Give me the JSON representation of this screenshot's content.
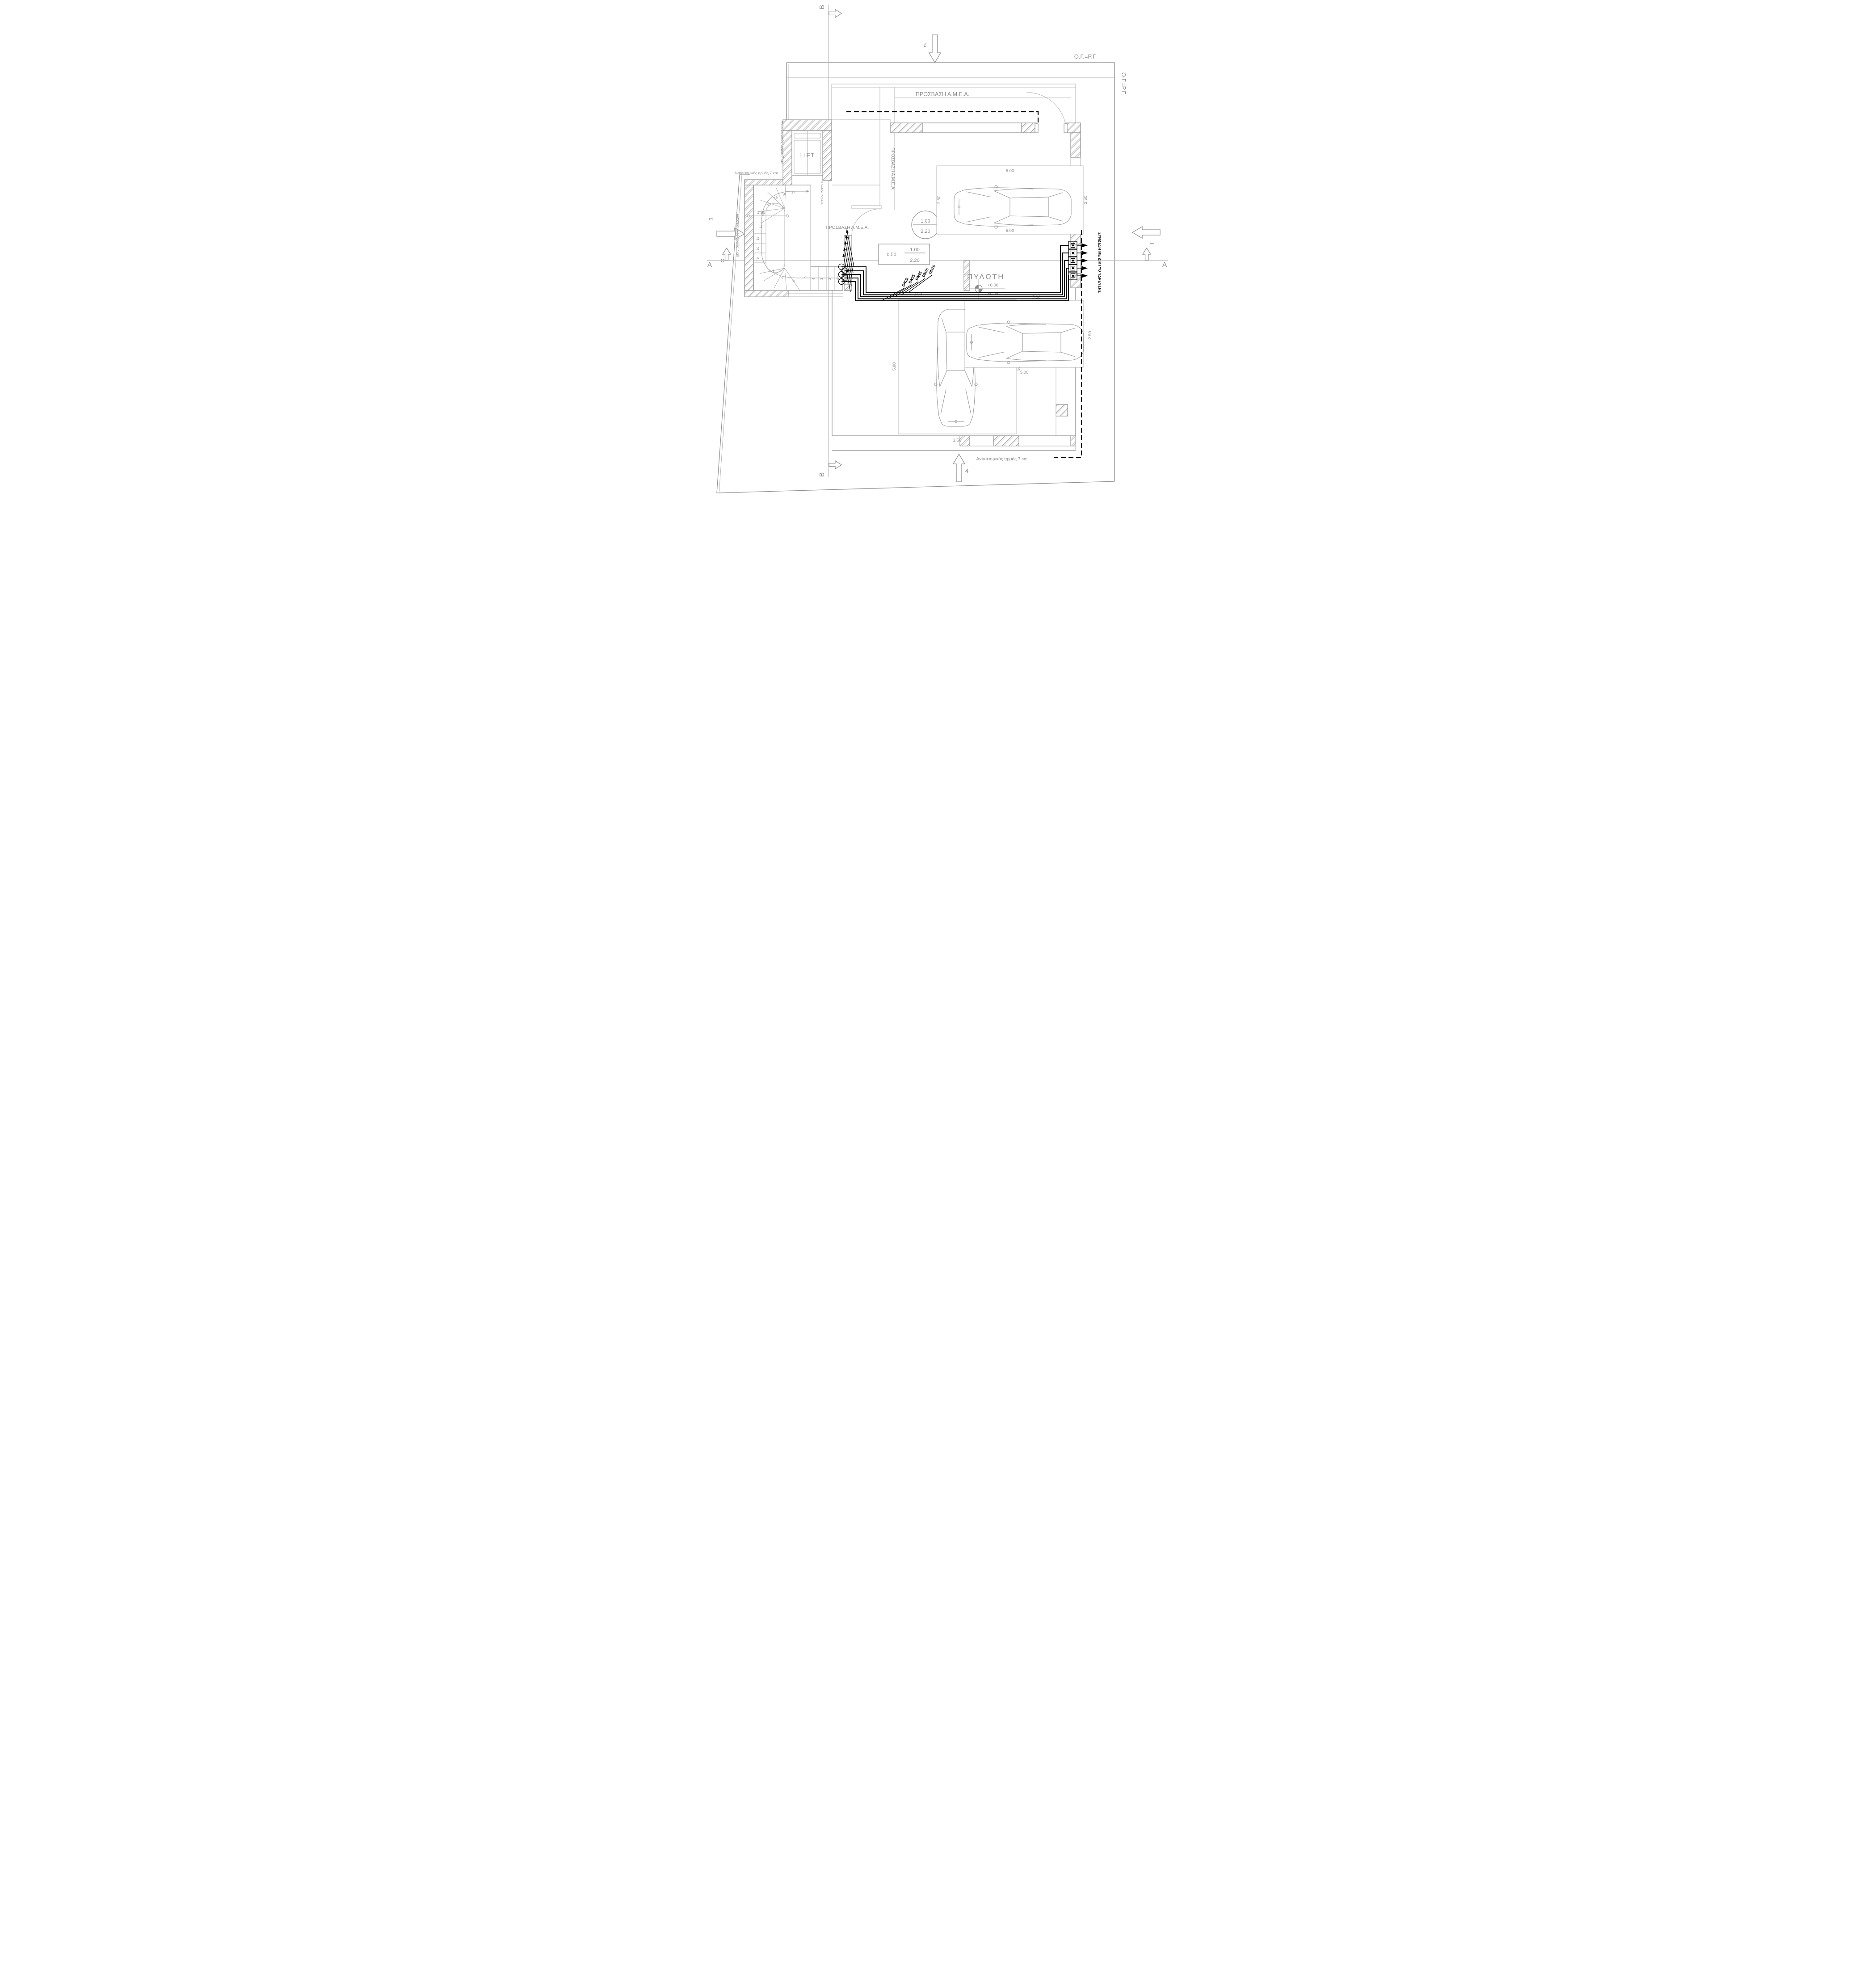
{
  "labels": {
    "og_rg": "Ο.Γ.=Ρ.Γ.",
    "access": "ΠΡΟΣΒΑΣΗ Α.Μ.Ε.Α.",
    "lift": "LIFT",
    "pilotis": "ΠΥΛΩΤΗ",
    "level_top": "+0.00",
    "level_bottom": "+0.05",
    "seismic": "Αντισεισμικός αρμός 7 cm",
    "connection": "ΣΥΝΔΕΣΗ ΜΕ ΔΙΚΤΥΟ ΥΔΡΕΥΣΗΣ",
    "dn25": "DN25"
  },
  "dims": {
    "d050": "0.50",
    "d100": "1.00",
    "d120": "1.20",
    "d220": "2.20",
    "d250": "2.50",
    "d500": "5.00"
  },
  "door_tag": {
    "width": "1.00",
    "height": "2.20",
    "side": "0.50"
  },
  "sections": {
    "a": "A",
    "b": "B"
  },
  "views": {
    "v1": "1",
    "v2": "2",
    "v3": "3",
    "v4": "4"
  },
  "stairs": {
    "steps": [
      "1",
      "2",
      "3",
      "4",
      "5",
      "6",
      "7",
      "8",
      "9",
      "10",
      "11",
      "12",
      "13",
      "14",
      "15",
      "16",
      "17"
    ]
  },
  "meters": {
    "count": 5
  }
}
